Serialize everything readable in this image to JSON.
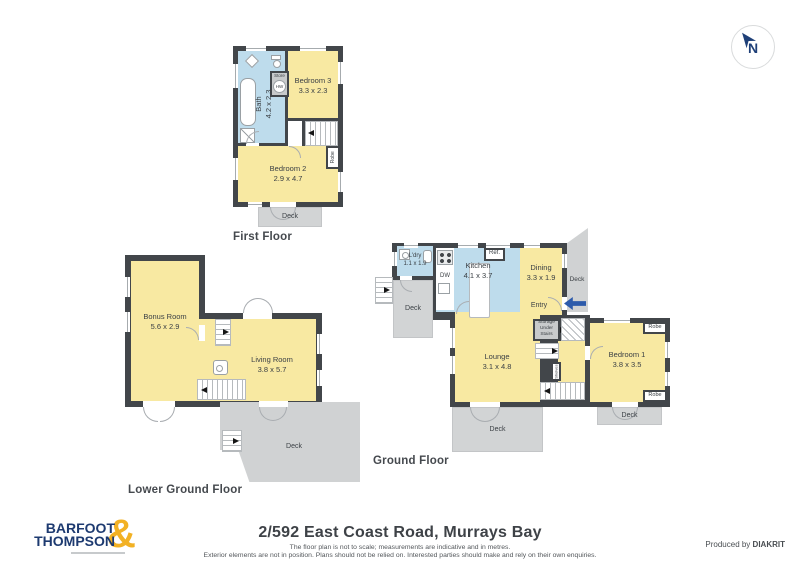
{
  "compass": {
    "label": "N"
  },
  "floors": {
    "first": {
      "title": "First Floor",
      "bath": {
        "name": "Bath",
        "dims": "4.2 x 2.3"
      },
      "store_label": "Store",
      "hw_label": "HW",
      "bedroom3": {
        "name": "Bedroom 3",
        "dims": "3.3 x 2.3"
      },
      "bedroom2": {
        "name": "Bedroom 2",
        "dims": "2.9 x 4.7"
      },
      "robe_label": "Robe",
      "deck_label": "Deck"
    },
    "ground": {
      "title": "Ground Floor",
      "laundry": {
        "name": "L'dry",
        "dims": "1.1 x 1.9"
      },
      "kitchen": {
        "name": "Kitchen",
        "dims": "4.1 x 3.7"
      },
      "dining": {
        "name": "Dining",
        "dims": "3.3 x 1.9"
      },
      "entry_label": "Entry",
      "ref_label": "Ref.",
      "dw_label": "DW",
      "lounge": {
        "name": "Lounge",
        "dims": "3.1 x 4.8"
      },
      "bedroom1": {
        "name": "Bedroom 1",
        "dims": "3.8 x 3.5"
      },
      "storage": {
        "line1": "Storage",
        "line2": "Under",
        "line3": "Stairs"
      },
      "shelves_label": "Shelves",
      "robe_top_label": "Robe",
      "robe_bottom_label": "Robe",
      "deck_left_label": "Deck",
      "deck_right_label": "Deck",
      "deck_lounge_label": "Deck",
      "deck_bedroom_label": "Deck"
    },
    "lower": {
      "title": "Lower Ground Floor",
      "bonus": {
        "name": "Bonus Room",
        "dims": "5.6 x 2.9"
      },
      "living": {
        "name": "Living Room",
        "dims": "3.8 x 5.7"
      },
      "deck_label": "Deck"
    }
  },
  "footer": {
    "address": "2/592 East Coast Road, Murrays Bay",
    "disclaimer_line1": "The floor plan is not to scale; measurements are indicative and in metres.",
    "disclaimer_line2": "Exterior elements are not in position. Plans should not be relied on. Interested parties should make and rely on their own enquiries.",
    "produced_by": "Produced by",
    "producer": "DIAKRIT"
  },
  "logo": {
    "word_top": "BARFOOT",
    "word_bottom": "THOMPSON",
    "ampersand": "&"
  },
  "colors": {
    "wall": "#42464a",
    "room_yellow": "#f8e9a2",
    "room_wet_blue": "#bedcec",
    "deck_gray": "#d2d4d5",
    "brand_navy": "#1d3a70",
    "brand_gold": "#f2b124",
    "entry_arrow_blue": "#2d5bab"
  }
}
